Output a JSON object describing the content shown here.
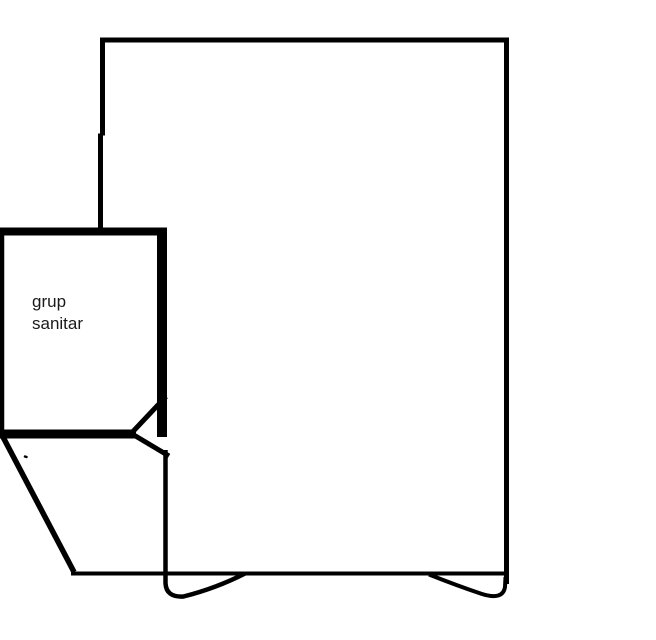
{
  "colors": {
    "background": "#ffffff",
    "stroke": "#000000",
    "text": "#1a1a1a"
  },
  "floor_plan": {
    "bathroom_label": {
      "line1": "grup",
      "line2": "sanitar"
    }
  }
}
